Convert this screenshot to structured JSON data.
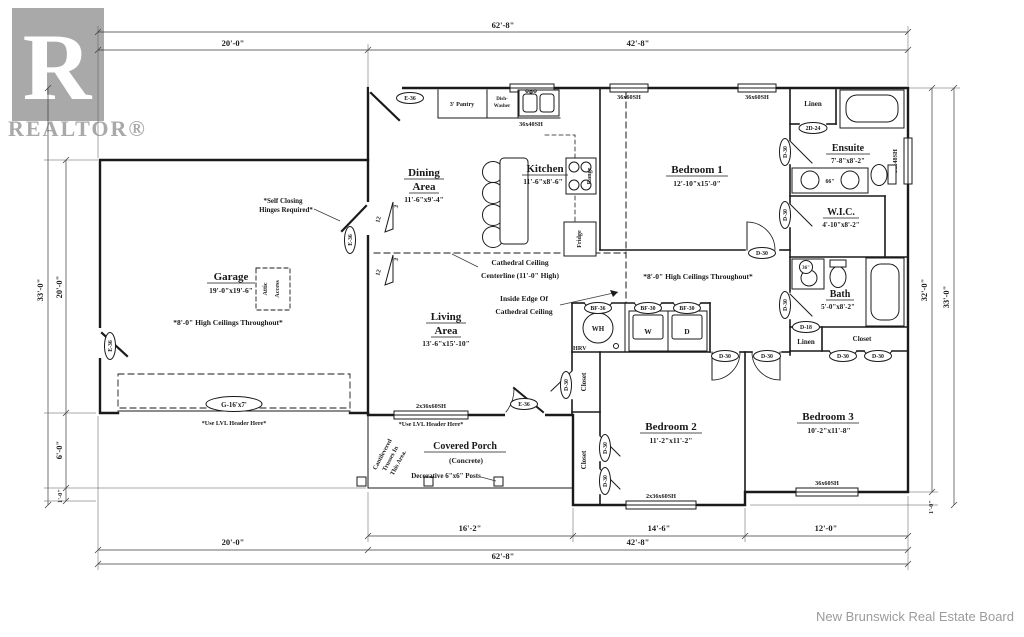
{
  "branding": {
    "logo_letter": "R",
    "logo_word": "REALTOR®",
    "logo_color": "#a9a9a9",
    "credit": "New Brunswick Real Estate Board"
  },
  "dims": {
    "overall_w": "62'-8\"",
    "left_w": "20'-0\"",
    "right_w": "42'-8\"",
    "b1": "16'-2\"",
    "b2": "14'-6\"",
    "b3": "12'-0\"",
    "h_outer": "33'-0\"",
    "h_inner": "32'-0\"",
    "garage_h": "20'-0\"",
    "porch_h": "6'-0\"",
    "step": "1'-0\""
  },
  "rooms": {
    "garage": {
      "name": "Garage",
      "size": "19'-0\"x19'-6\""
    },
    "dining": {
      "l1": "Dining",
      "l2": "Area",
      "size": "11'-6\"x9'-4\""
    },
    "kitchen": {
      "name": "Kitchen",
      "size": "11'-6\"x8'-6\""
    },
    "living": {
      "l1": "Living",
      "l2": "Area",
      "size": "13'-6\"x15'-10\""
    },
    "bedroom1": {
      "name": "Bedroom 1",
      "size": "12'-10\"x15'-0\""
    },
    "bedroom2": {
      "name": "Bedroom 2",
      "size": "11'-2\"x11'-2\""
    },
    "bedroom3": {
      "name": "Bedroom 3",
      "size": "10'-2\"x11'-8\""
    },
    "ensuite": {
      "name": "Ensuite",
      "size": "7'-8\"x8'-2\""
    },
    "wic": {
      "name": "W.I.C.",
      "size": "4'-10\"x8'-2\""
    },
    "bath": {
      "name": "Bath",
      "size": "5'-0\"x8'-2\""
    },
    "porch": {
      "name": "Covered Porch",
      "sub": "(Concrete)"
    }
  },
  "features": {
    "pantry": "3' Pantry",
    "dw1": "Dish-",
    "dw2": "Washer",
    "range": "Range",
    "fridge": "Fridge",
    "linen": "Linen",
    "closet": "Closet",
    "attic1": "Attic",
    "attic2": "Access",
    "washer": "W",
    "dryer": "D",
    "wh": "WH",
    "hrv": "HRV",
    "v66": "66\"",
    "v36": "36\""
  },
  "openings": {
    "garage_door": "G-16'x7'",
    "w3660": "36x60SH",
    "w3640": "36x40SH",
    "w3648": "36x48SH",
    "w23660": "2x36x60SH",
    "e36": "E-36",
    "d30": "D-30",
    "d18": "D-18",
    "dd24": "2D-24",
    "bf30": "BF-30",
    "bf36": "BF-36"
  },
  "notes": {
    "self1": "*Self Closing",
    "self2": "Hinges Required*",
    "ceil8": "*8'-0\" High Ceilings Throughout*",
    "cath1": "Cathedral Ceiling",
    "cath2": "Centerline (11'-0\" High)",
    "edge1": "Inside Edge Of",
    "edge2": "Cathedral Ceiling",
    "cant1": "Cantilevered",
    "cant2": "Trusses In",
    "cant3": "This Area.",
    "posts": "Decorative 6\"x6\" Posts",
    "lvl": "*Use LVL Header Here*",
    "rise": "12",
    "run": "3"
  }
}
